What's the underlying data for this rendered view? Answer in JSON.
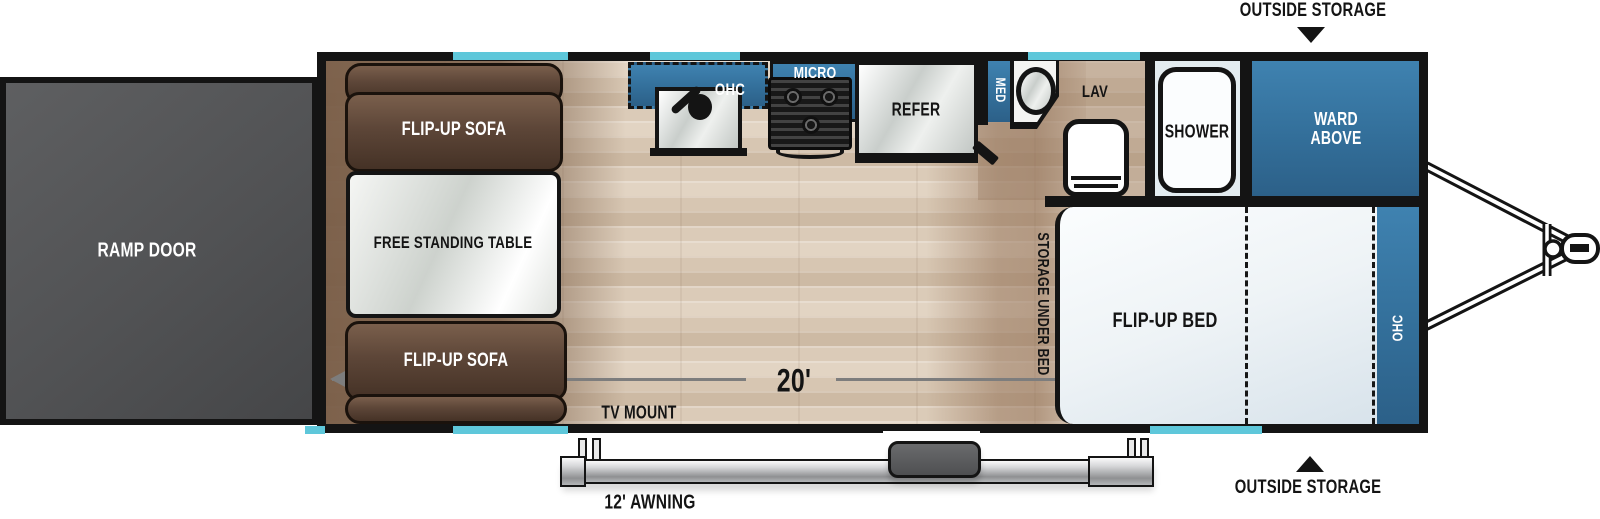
{
  "title": "Travel trailer floor plan",
  "labels": {
    "ramp_door": "RAMP DOOR",
    "sofa_top": "FLIP-UP SOFA",
    "sofa_bottom": "FLIP-UP SOFA",
    "table": "FREE STANDING TABLE",
    "kitchen_ohc": "OHC",
    "micro": "MICRO",
    "refer": "REFER",
    "med": "MED",
    "lav": "LAV",
    "shower": "SHOWER",
    "ward_above": "WARD ABOVE",
    "storage_under_bed": "STORAGE UNDER BED",
    "flip_up_bed": "FLIP-UP BED",
    "bedroom_ohc": "OHC",
    "tv_mount": "TV MOUNT",
    "outside_storage_top": "OUTSIDE STORAGE",
    "outside_storage_bottom": "OUTSIDE STORAGE"
  },
  "dimensions": {
    "interior_length": "20'",
    "awning": "12' AWNING"
  },
  "colors": {
    "cabinet_blue": "#36749E",
    "window_cyan": "#5EC7DA",
    "wall_black": "#141414",
    "sofa_brown": "#5D4638",
    "ramp_gray": "#57585A",
    "floor_beige": "#DCCDBB",
    "floor_brown": "#8B6F5B",
    "dimension_gray": "#7D7D7D"
  }
}
